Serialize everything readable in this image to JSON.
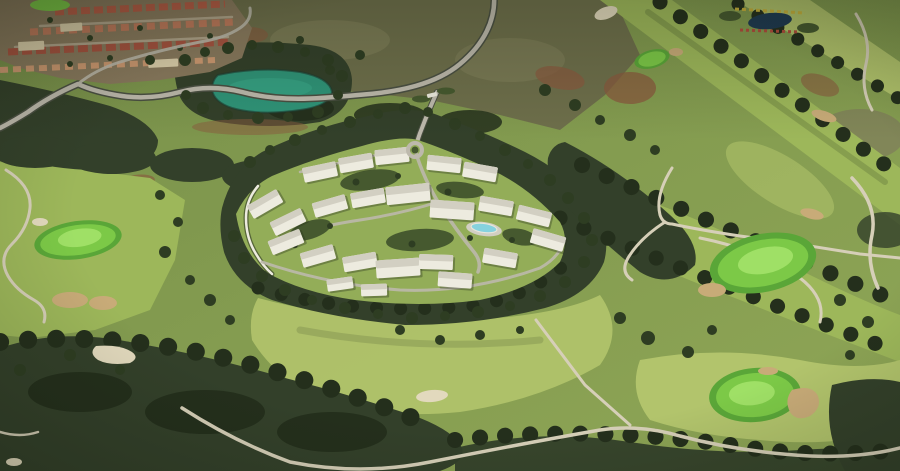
{
  "scene": {
    "kind": "aerial-render",
    "landmarks": [
      "hillside-village",
      "lake",
      "access-road",
      "entrance-gate",
      "roundabout",
      "residential-development",
      "swimming-pool",
      "golf-fairways",
      "golf-greens",
      "sand-bunkers",
      "woodland",
      "footpaths",
      "ornamental-garden"
    ]
  },
  "palette": {
    "base-grass": "#7f984e",
    "fairway": "#9db75a",
    "fairway-light": "#b2c46c",
    "plot-lawn": "#93ad58",
    "green-fringe": "#5aa638",
    "green": "#7cc947",
    "green-light": "#9fe066",
    "scrub": "#6e6f4b",
    "scrub-light": "#80805a",
    "dirt": "#8a5a3e",
    "forest": "#33402a",
    "forest-dark": "#242f1c",
    "tree": "#2e3d22",
    "tree-light": "#46592f",
    "pond": "#2f9478",
    "pond-light": "#3aa98a",
    "pool": "#86d2de",
    "road": "#bdb9ac",
    "road-edge": "#4a4f42",
    "street": "#b9ad94",
    "path": "#d6cfb8",
    "sand": "#c8ab78",
    "sand-light": "#e2d9bd",
    "village-earth": "#8a7a5e",
    "village-roof-1": "#b65c46",
    "village-roof-2": "#c07a5c",
    "village-roof-3": "#a85340",
    "village-roof-4": "#cf9a72",
    "village-cream": "#ddd0ac",
    "building": "#edebdf",
    "building-roof": "#d2cfc2",
    "garden-pond": "#1e3a52",
    "flower-yellow": "#c8b23c",
    "flower-red": "#b24c3c"
  }
}
